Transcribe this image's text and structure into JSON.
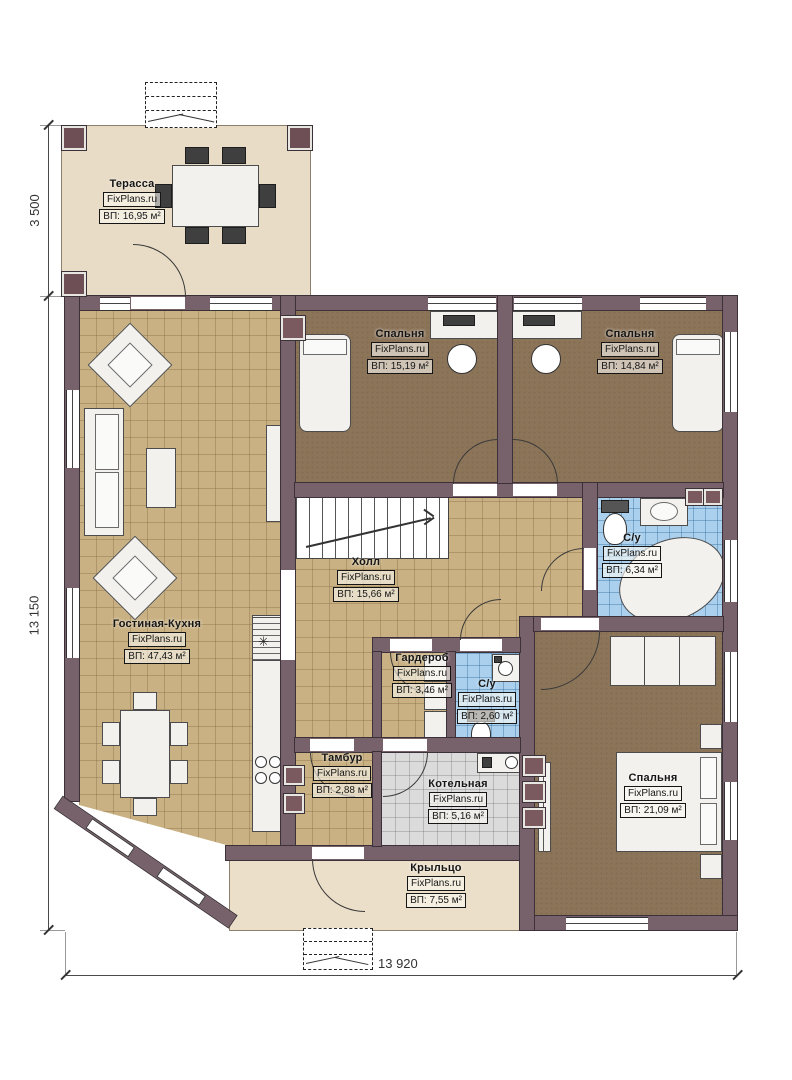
{
  "meta": {
    "brand": "FixPlans.ru",
    "plan_type": "floor-plan"
  },
  "dimensions": {
    "top_left_vertical": "3 500",
    "left_vertical": "13 150",
    "bottom_horizontal": "13 920"
  },
  "icons": {
    "fridge": "✳"
  },
  "colors": {
    "wall": "#77616a",
    "wall_outline": "#3c3138",
    "floor_tile_tan": "#c9b183",
    "floor_carpet_brown": "#8c7459",
    "floor_tile_blue": "#abd0ed",
    "floor_tile_grey": "#dbdbdb",
    "terrace_beige": "#e9dcc6"
  },
  "rooms": [
    {
      "id": "terrace",
      "name": "Терасса",
      "brand": "FixPlans.ru",
      "area": "ВП: 16,95 м²"
    },
    {
      "id": "bedroom1",
      "name": "Спальня",
      "brand": "FixPlans.ru",
      "area": "ВП: 15,19 м²"
    },
    {
      "id": "bedroom2",
      "name": "Спальня",
      "brand": "FixPlans.ru",
      "area": "ВП: 14,84 м²"
    },
    {
      "id": "bathroom1",
      "name": "С/у",
      "brand": "FixPlans.ru",
      "area": "ВП: 6,34 м²"
    },
    {
      "id": "hall",
      "name": "Холл",
      "brand": "FixPlans.ru",
      "area": "ВП: 15,66 м²"
    },
    {
      "id": "living",
      "name": "Гостиная-Кухня",
      "brand": "FixPlans.ru",
      "area": "ВП: 47,43 м²"
    },
    {
      "id": "wardrobe",
      "name": "Гардероб",
      "brand": "FixPlans.ru",
      "area": "ВП: 3,46 м²"
    },
    {
      "id": "bathroom2",
      "name": "С/у",
      "brand": "FixPlans.ru",
      "area": "ВП: 2,60 м²"
    },
    {
      "id": "tambour",
      "name": "Тамбур",
      "brand": "FixPlans.ru",
      "area": "ВП: 2,88 м²"
    },
    {
      "id": "boiler",
      "name": "Котельная",
      "brand": "FixPlans.ru",
      "area": "ВП: 5,16 м²"
    },
    {
      "id": "bedroom3",
      "name": "Спальня",
      "brand": "FixPlans.ru",
      "area": "ВП: 21,09 м²"
    },
    {
      "id": "porch",
      "name": "Крыльцо",
      "brand": "FixPlans.ru",
      "area": "ВП: 7,55 м²"
    }
  ]
}
